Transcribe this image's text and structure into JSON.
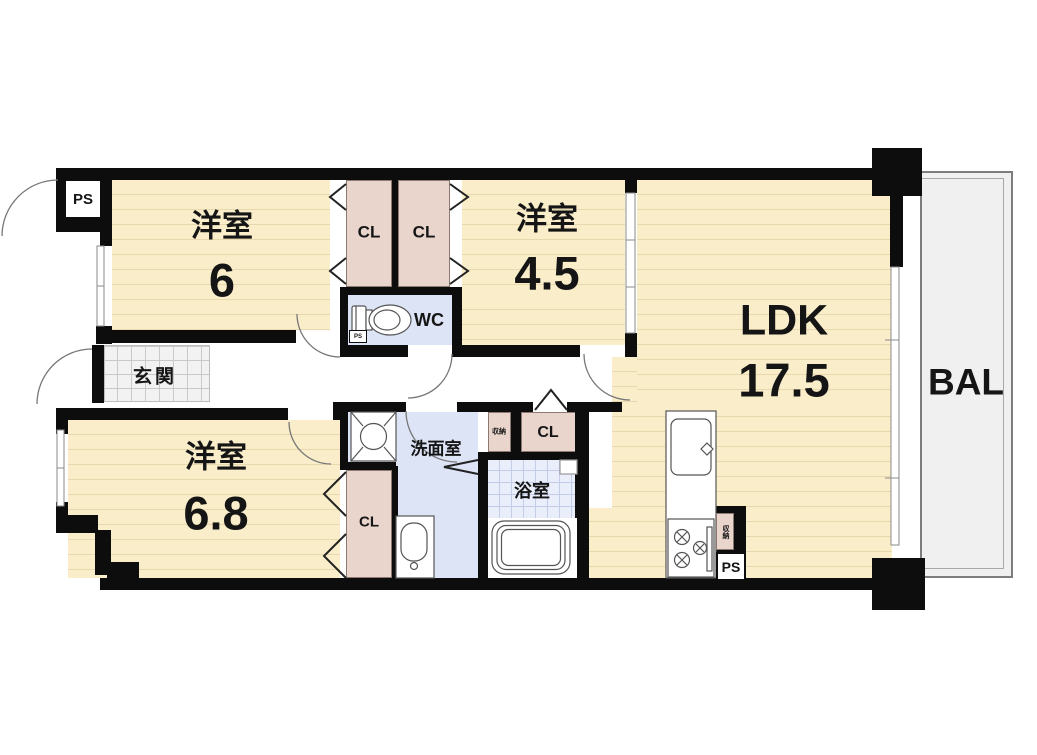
{
  "labels": {
    "room_a": {
      "name": "洋室",
      "size": "6"
    },
    "room_b": {
      "name": "洋室",
      "size": "4.5"
    },
    "room_c": {
      "name": "洋室",
      "size": "6.8"
    },
    "ldk": {
      "name": "LDK",
      "size": "17.5"
    },
    "balcony": "BAL",
    "entrance": "玄関",
    "toilet": "WC",
    "washroom": "洗面室",
    "bathroom": "浴室",
    "closet": "CL",
    "storage": "収納",
    "pipe_space": "PS"
  },
  "colors": {
    "wall": "#0d0d0d",
    "floor": "#f9edca",
    "floor_stripe": "#e7d9ad",
    "closet": "#e9d5cc",
    "wet_room": "#dce4f6",
    "bath_tile": "#e9eefa",
    "bath_tile_line": "#c3cdea",
    "balcony": "#f0f0f0",
    "entrance_tile": "#f2f2f2"
  }
}
